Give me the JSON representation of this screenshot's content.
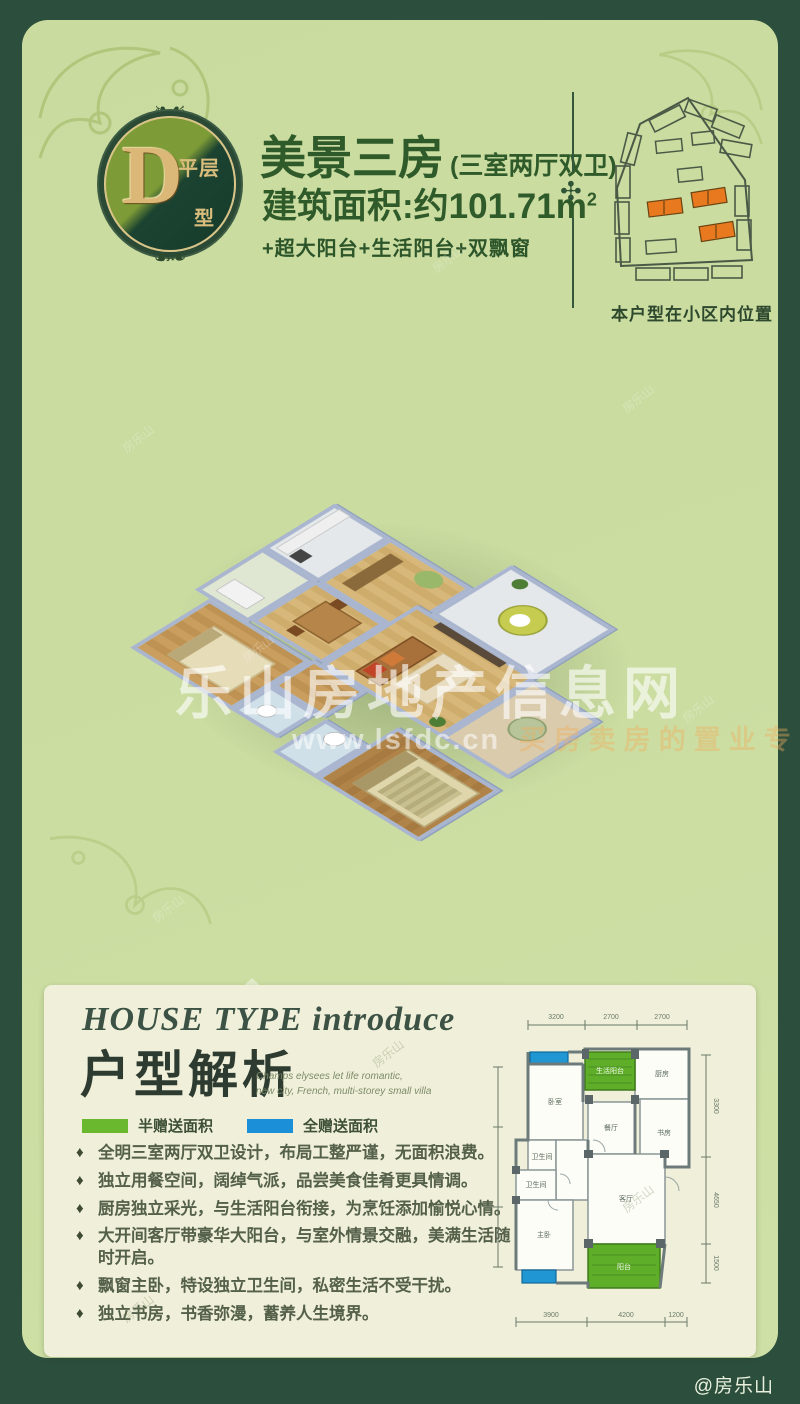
{
  "badge": {
    "letter": "D",
    "label_top": "平层",
    "label_bottom": "型"
  },
  "header": {
    "title": "美景三房",
    "title_suffix": "(三室两厅双卫)",
    "area_label": "建筑面积:约101.71m",
    "area_sup": "2",
    "features": "+超大阳台+生活阳台+双飘窗"
  },
  "siteplan": {
    "caption": "本户型在小区内位置",
    "highlight_color": "#e8791f"
  },
  "render_watermark": {
    "line1": "乐山房地产信息网",
    "url": "www.lsfdc.cn",
    "tagline": "买房卖房的置业专家"
  },
  "corner_watermark": "@房乐山",
  "scatter_watermark": "房乐山",
  "intro": {
    "title_en": "HOUSE TYPE  introduce",
    "title_cn": "户型解析",
    "subtitle_en_line1": "Champs elysees let life romantic,",
    "subtitle_en_line2": "new city, French, multi-storey small villa",
    "legend": [
      {
        "label": "半赠送面积",
        "color": "#6ab82d"
      },
      {
        "label": "全赠送面积",
        "color": "#1b8fd8"
      }
    ],
    "bullets": [
      "全明三室两厅双卫设计，布局工整严谨，无面积浪费。",
      "独立用餐空间，阔绰气派，品尝美食佳肴更具情调。",
      "厨房独立采光，与生活阳台衔接，为烹饪添加愉悦心情。",
      "大开间客厅带豪华大阳台，与室外情景交融，美满生活随时开启。",
      "飘窗主卧，特设独立卫生间，私密生活不受干扰。",
      "独立书房，书香弥漫，蓄养人生境界。"
    ]
  },
  "plan2d": {
    "rooms": [
      {
        "label": "卧室"
      },
      {
        "label": "生活阳台"
      },
      {
        "label": "厨房"
      },
      {
        "label": "餐厅"
      },
      {
        "label": "书房"
      },
      {
        "label": "卫生间"
      },
      {
        "label": "卫生间"
      },
      {
        "label": "主卧"
      },
      {
        "label": "客厅"
      },
      {
        "label": "阳台"
      }
    ],
    "dims_top": [
      "3200",
      "2700",
      "2700"
    ],
    "dims_right": [
      "3300",
      "4650",
      "1500"
    ],
    "dims_bottom": [
      "3900",
      "4200",
      "1200"
    ]
  }
}
